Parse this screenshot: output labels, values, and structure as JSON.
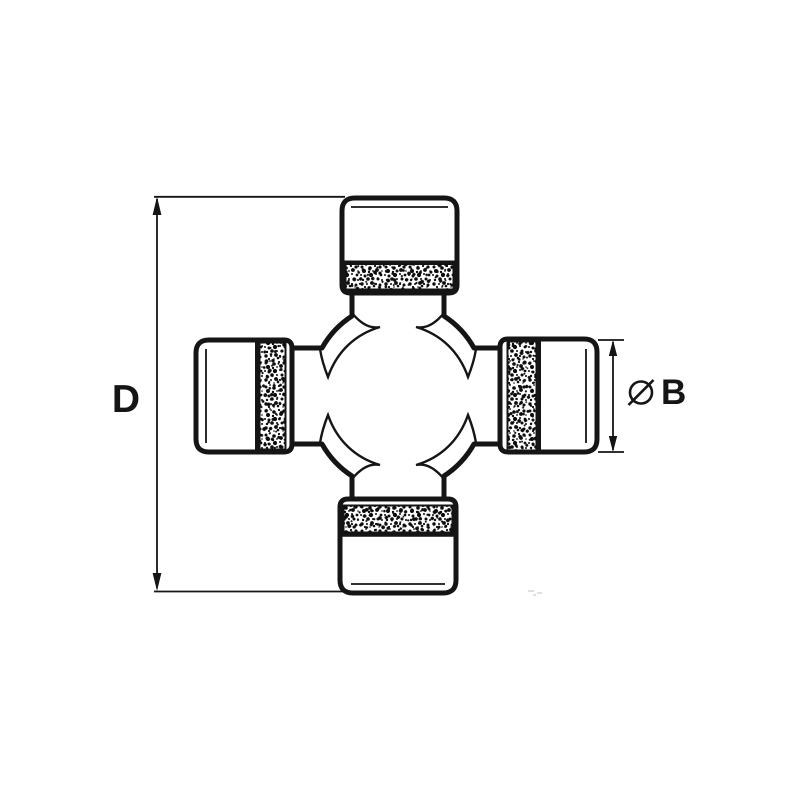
{
  "page": {
    "background_color": "#ffffff",
    "line_color": "#151515",
    "description_labels": {
      "dim_height_label": "D",
      "dim_diameter_symbol": "Ø",
      "dim_diameter_label": "B"
    }
  },
  "drawing": {
    "dim_height": {
      "label": "D"
    },
    "dim_diameter": {
      "symbol": "Ø",
      "label": "B"
    }
  }
}
